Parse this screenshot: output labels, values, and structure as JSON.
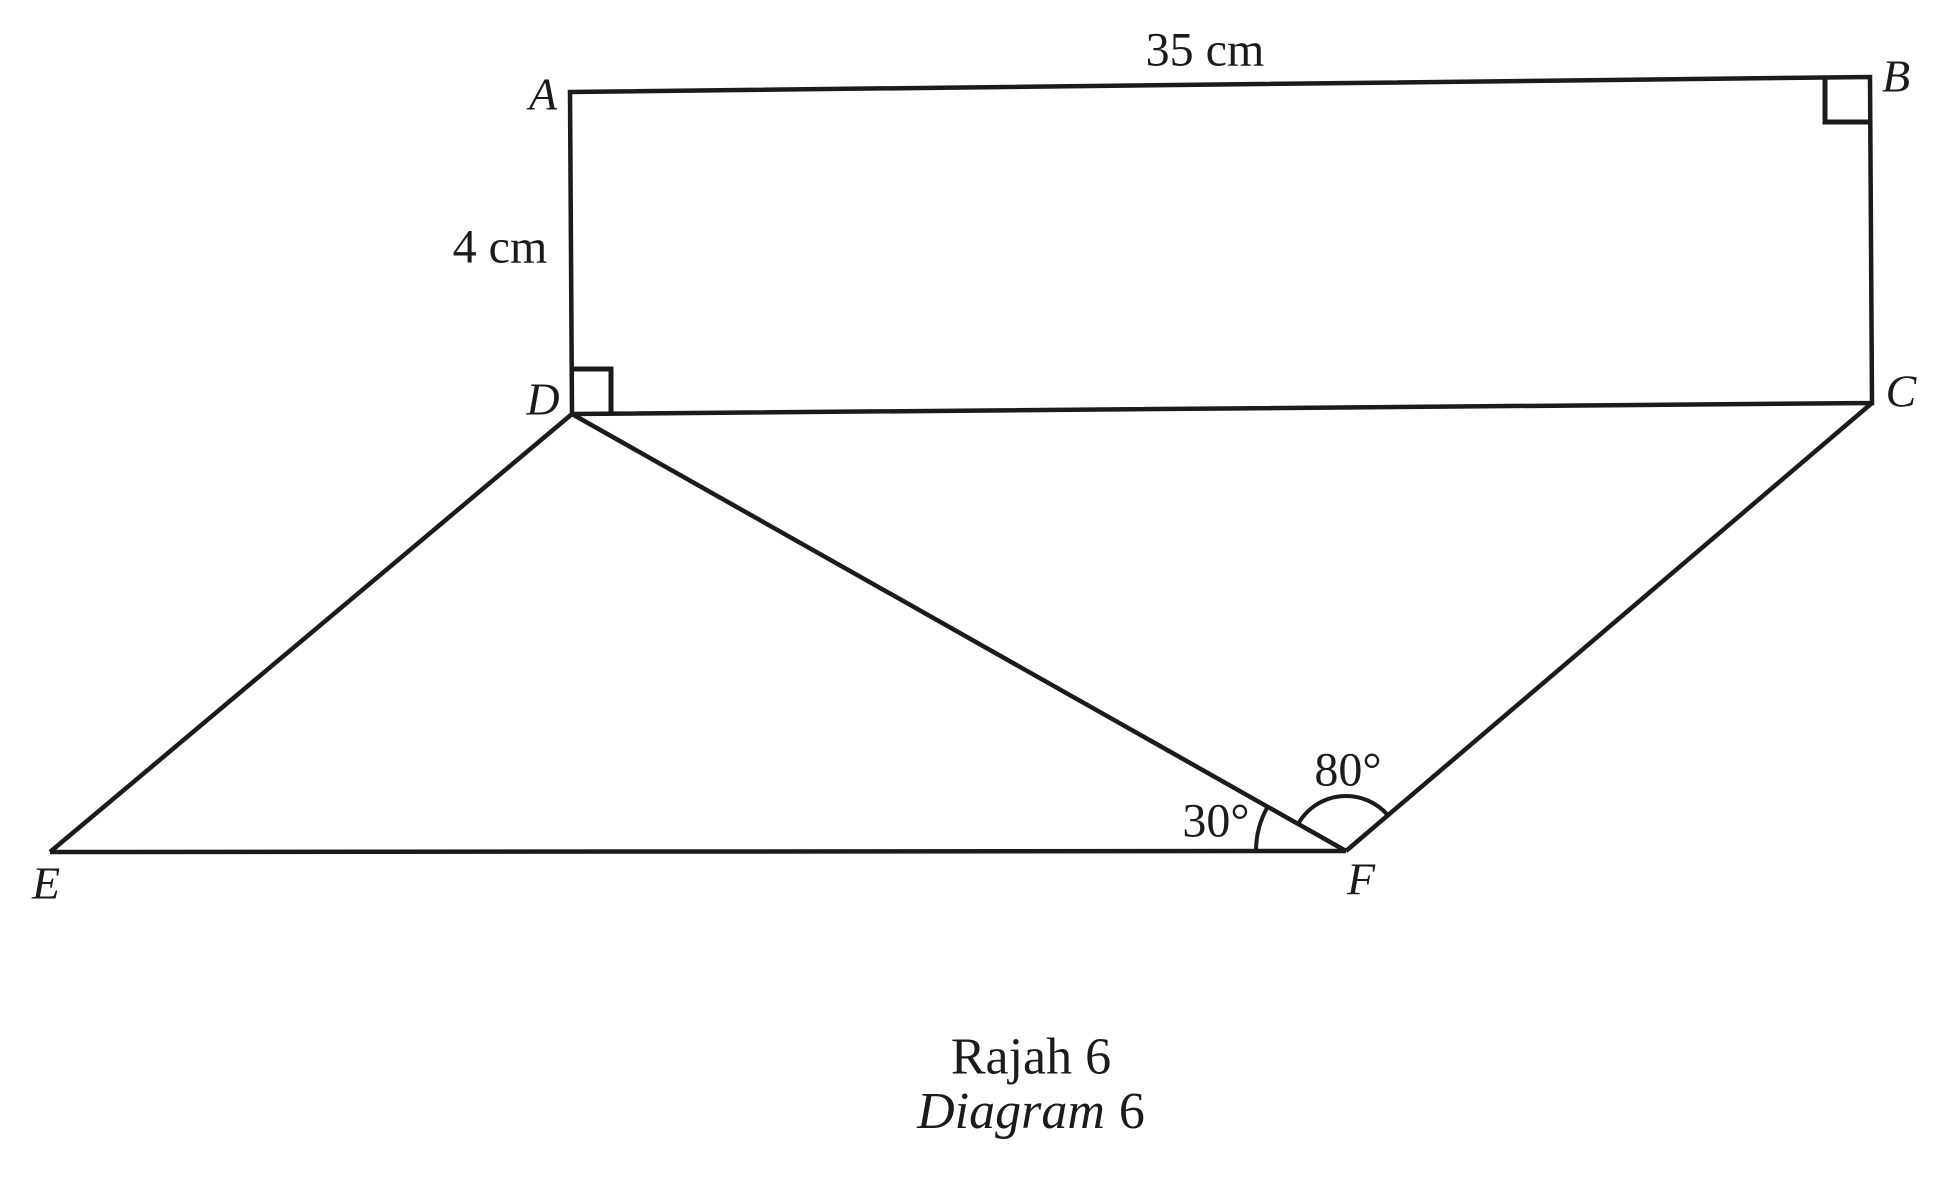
{
  "colors": {
    "background": "#ffffff",
    "ink": "#1b1b1b"
  },
  "diagram": {
    "vertex_labels": {
      "a": "A",
      "b": "B",
      "c": "C",
      "d": "D",
      "e": "E",
      "f": "F"
    },
    "side_labels": {
      "ab_length": "35 cm",
      "ad_length": "4 cm"
    },
    "angle_labels": {
      "dfe": "30°",
      "dfc": "80°"
    }
  },
  "caption": {
    "line1": "Rajah 6",
    "line2_word": "Diagram",
    "line2_number": "6"
  }
}
